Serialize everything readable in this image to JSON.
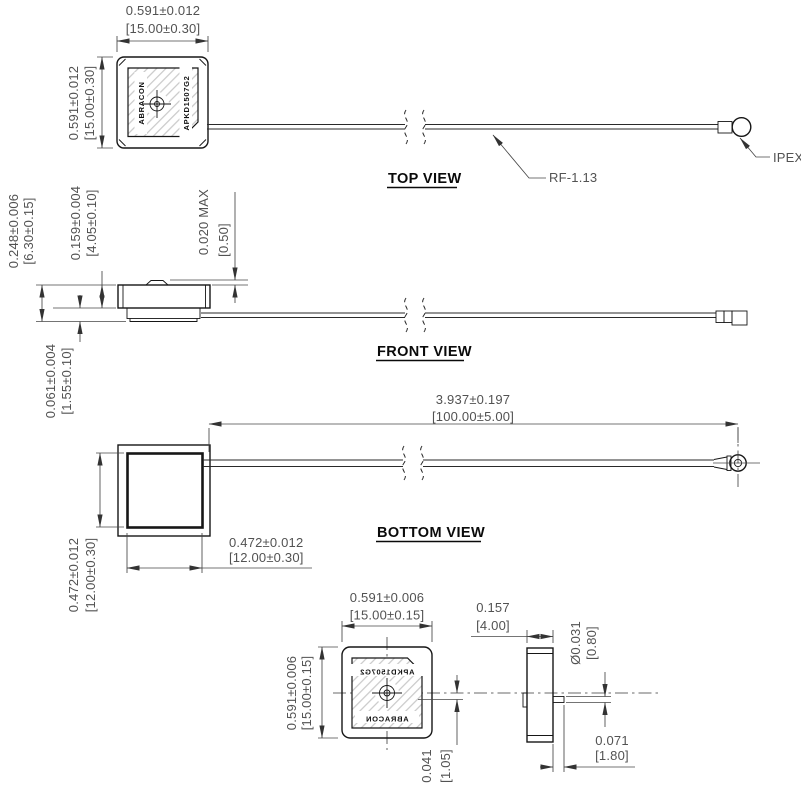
{
  "drawing": {
    "part": {
      "brand": "ABRACON",
      "model": "APKD1507G2"
    },
    "colors": {
      "line": "#161616",
      "dim_line": "#474747",
      "dim_text": "#525252",
      "hatch": "#c4c4c4"
    },
    "top_view": {
      "label": "TOP VIEW",
      "width": {
        "inches": "0.591±0.012",
        "mm": "[15.00±0.30]"
      },
      "height": {
        "inches": "0.591±0.012",
        "mm": "[15.00±0.30]"
      },
      "cable_label": "RF-1.13",
      "connector_label": "IPEX"
    },
    "front_view": {
      "label": "FRONT VIEW",
      "overall_height": {
        "inches": "0.248±0.006",
        "mm": "[6.30±0.15]"
      },
      "patch_height": {
        "inches": "0.159±0.004",
        "mm": "[4.05±0.10]"
      },
      "pin_protrusion": {
        "inches": "0.020  MAX",
        "mm": "[0.50]"
      },
      "pcb_thickness": {
        "inches": "0.061±0.004",
        "mm": "[1.55±0.10]"
      }
    },
    "bottom_view": {
      "label": "BOTTOM  VIEW",
      "cable_length": {
        "inches": "3.937±0.197",
        "mm": "[100.00±5.00]"
      },
      "pad_width": {
        "inches": "0.472±0.012",
        "mm": "[12.00±0.30]"
      },
      "pad_height": {
        "inches": "0.472±0.012",
        "mm": "[12.00±0.30]"
      }
    },
    "back_view": {
      "width": {
        "inches": "0.591±0.006",
        "mm": "[15.00±0.15]"
      },
      "height": {
        "inches": "0.591±0.006",
        "mm": "[15.00±0.15]"
      },
      "pin_offset": {
        "inches": "0.041",
        "mm": "[1.05]"
      },
      "thickness": {
        "inches": "0.157",
        "mm": "[4.00]"
      },
      "pin_diameter": {
        "inches": "Ø0.031",
        "mm": "[0.80]"
      },
      "pin_length": {
        "inches": "0.071",
        "mm": "[1.80]"
      }
    }
  }
}
